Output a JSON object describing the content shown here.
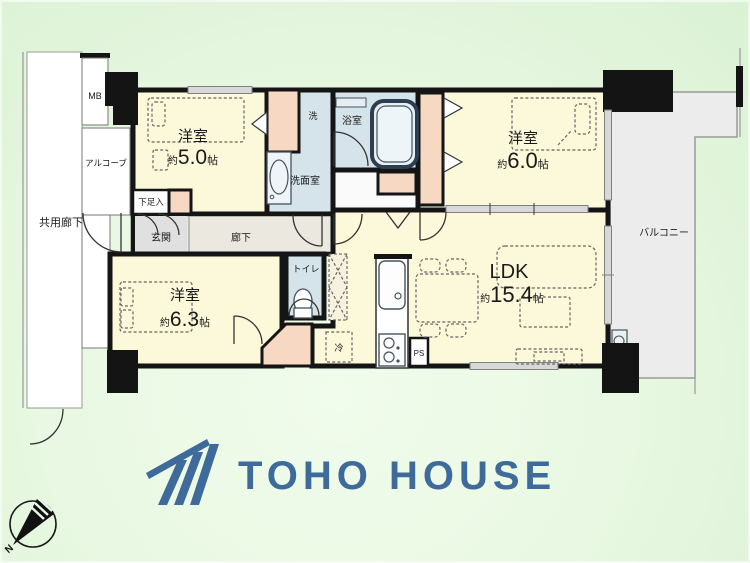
{
  "plan": {
    "labels": {
      "common_corridor": "共用廊下",
      "meter_box": "MB",
      "alcove": "アルコーブ",
      "shoe_box": "下足入",
      "entrance": "玄関",
      "hallway": "廊下",
      "washer": "洗",
      "bathroom": "浴室",
      "washroom": "洗面室",
      "toilet": "トイレ",
      "fridge": "冷",
      "pipe_space": "PS",
      "balcony": "バルコニー"
    },
    "rooms": {
      "bedroom5": {
        "type": "洋室",
        "approx": "約",
        "size": "5.0",
        "unit": "帖"
      },
      "bedroom6": {
        "type": "洋室",
        "approx": "約",
        "size": "6.0",
        "unit": "帖"
      },
      "bedroom63": {
        "type": "洋室",
        "approx": "約",
        "size": "6.3",
        "unit": "帖"
      },
      "ldk": {
        "type": "LDK",
        "approx": "約",
        "size": "15.4",
        "unit": "帖"
      }
    }
  },
  "branding": {
    "company": "TOHO HOUSE"
  },
  "compass": {
    "north": "N"
  },
  "colors": {
    "room_fill": "#fcf8da",
    "closet_fill": "#f7d8c3",
    "wet_fill": "#d4e4ea",
    "hall_fill": "#eae8df",
    "balcony_fill": "#ececec",
    "wall": "#151515",
    "logo_blue": "#3e6b9a",
    "background_green": "#e6f7e0"
  }
}
